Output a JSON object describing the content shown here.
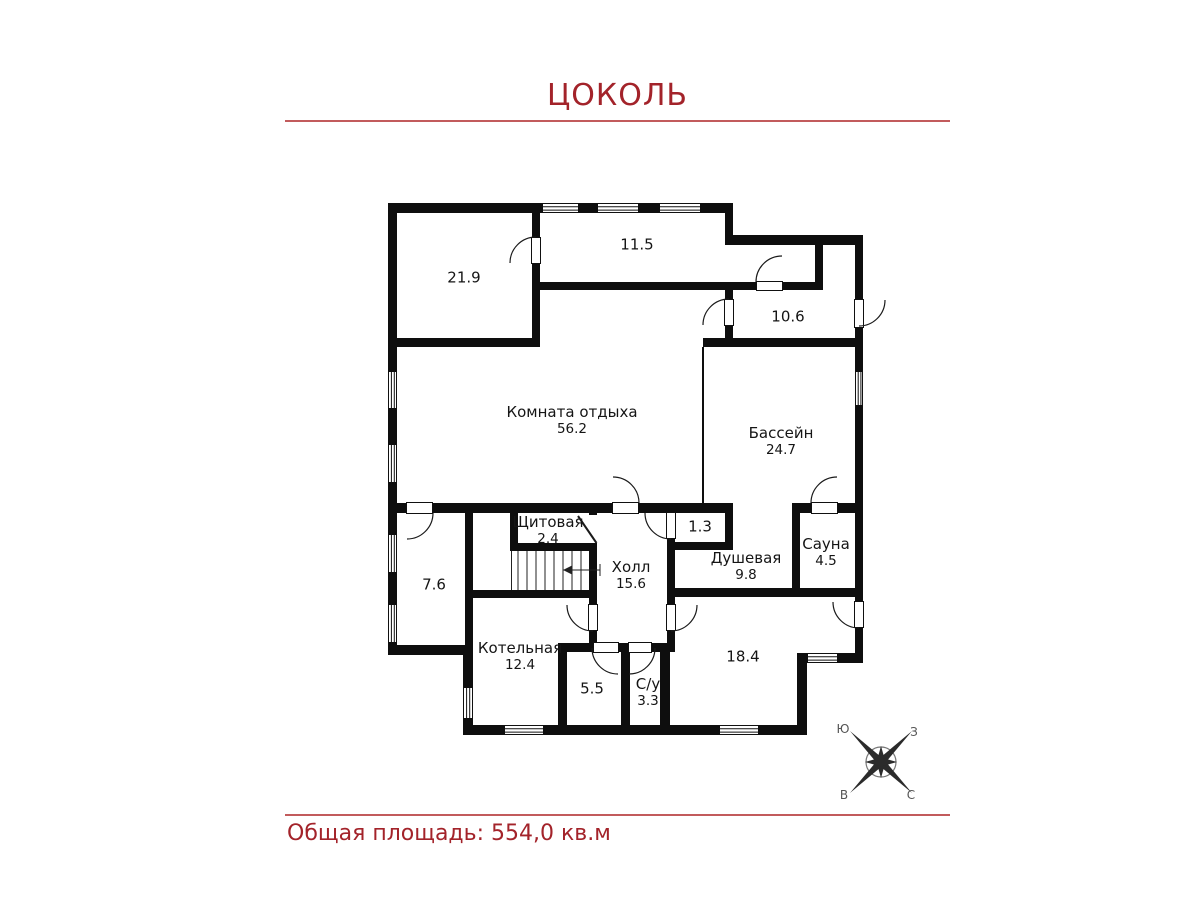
{
  "page": {
    "title": "ЦОКОЛЬ",
    "total_area_label": "Общая площадь: 554,0 кв.м"
  },
  "rooms": [
    {
      "name": "",
      "area": "21.9"
    },
    {
      "name": "",
      "area": "11.5"
    },
    {
      "name": "",
      "area": "10.6"
    },
    {
      "name": "Комната отдыха",
      "area": "56.2"
    },
    {
      "name": "Бассейн",
      "area": "24.7"
    },
    {
      "name": "Щитовая",
      "area": "2.4"
    },
    {
      "name": "",
      "area": "1.3"
    },
    {
      "name": "Душевая",
      "area": "9.8"
    },
    {
      "name": "Сауна",
      "area": "4.5"
    },
    {
      "name": "Холл",
      "area": "15.6"
    },
    {
      "name": "",
      "area": "7.6"
    },
    {
      "name": "Котельная",
      "area": "12.4"
    },
    {
      "name": "",
      "area": "5.5"
    },
    {
      "name": "С/у",
      "area": "3.3"
    },
    {
      "name": "",
      "area": "18.4"
    }
  ],
  "compass": {
    "top_left": "Ю",
    "top_right": "З",
    "bottom_left": "В",
    "bottom_right": "С"
  },
  "colors": {
    "accent": "#a3232a",
    "divider": "#c25b5c",
    "wall": "#0e0e0e"
  }
}
